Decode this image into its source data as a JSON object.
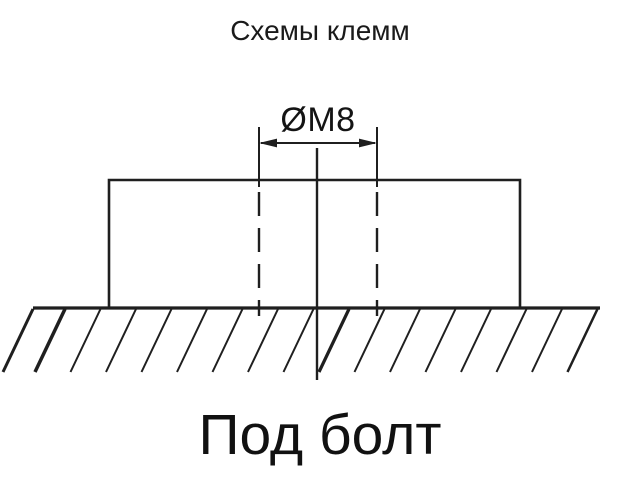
{
  "page": {
    "background": "#ffffff",
    "line_color": "#1f1f1f",
    "text_color": "#111111"
  },
  "header": {
    "title": "Схемы клемм"
  },
  "diagram": {
    "dimension_label": "ØM8",
    "caption": "Под болт"
  }
}
